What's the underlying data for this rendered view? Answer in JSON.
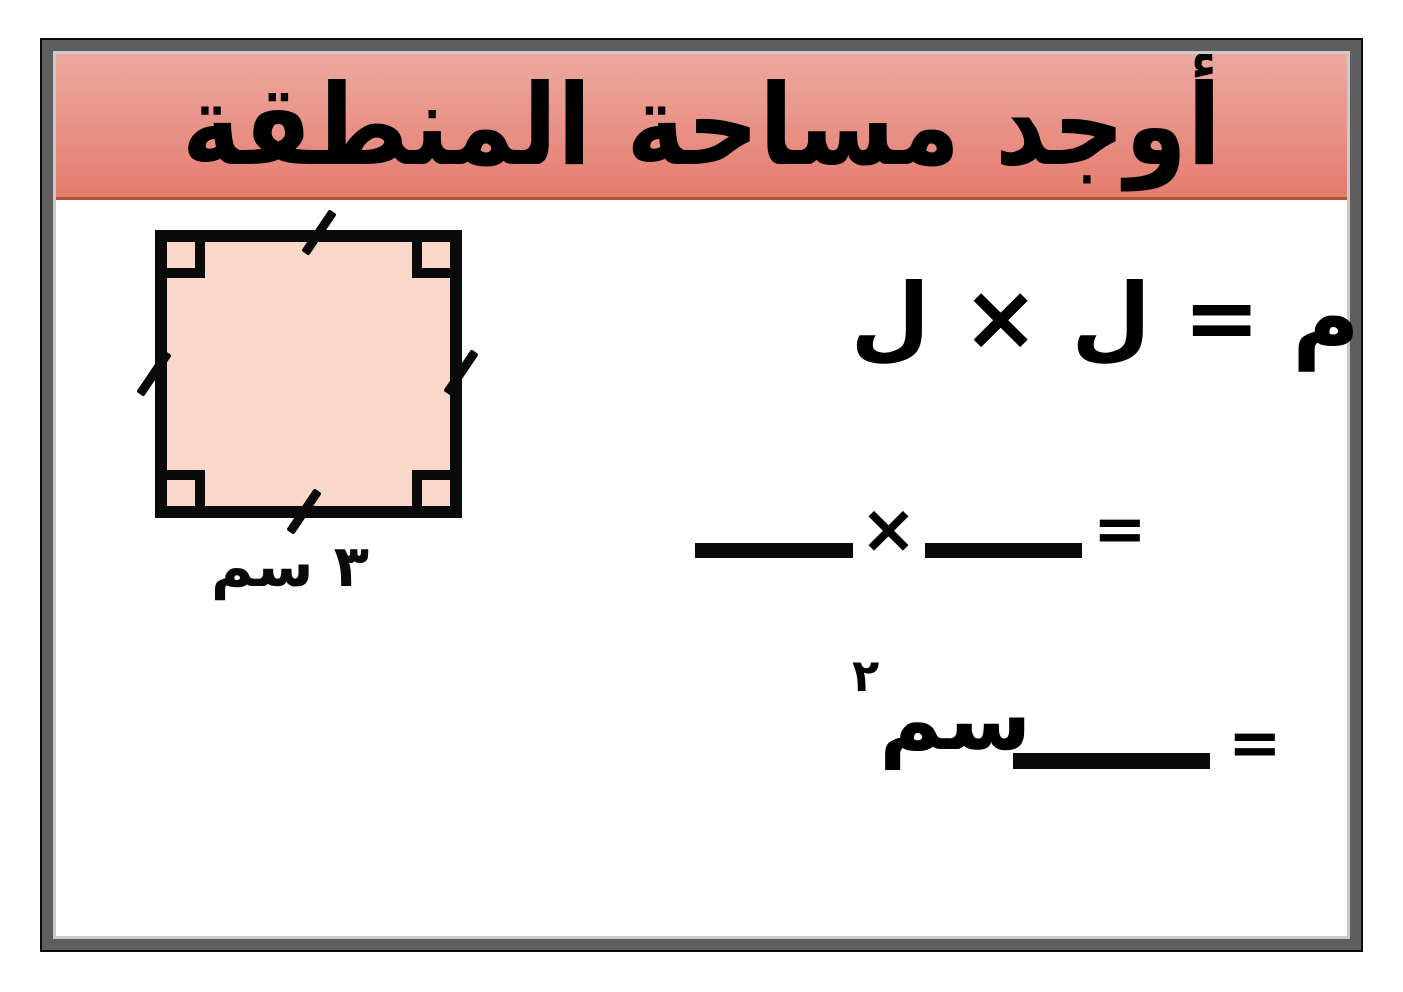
{
  "header": {
    "title": "أوجد مساحة المنطقة",
    "colors": {
      "gradient_top": "#eda99f",
      "gradient_bottom": "#e47d6e",
      "underline": "#b0553a",
      "text": "#000000"
    }
  },
  "frame": {
    "outer_line": "#0a0a0a",
    "band": "#5e5e5e",
    "inner_line": "#cacaca",
    "background": "#ffffff"
  },
  "figure": {
    "shape": "square",
    "fill_color": "#f9d8c9",
    "outline_color": "#0a0a0a",
    "side_label": "٣ سم",
    "right_angle_markers": 4,
    "tick_marks": 4
  },
  "equations": {
    "formula_line": "م = ل × ل",
    "work_line": {
      "equals": "=",
      "times": "×"
    },
    "answer_line": {
      "equals": "=",
      "unit": "سم",
      "exponent": "٢"
    }
  }
}
